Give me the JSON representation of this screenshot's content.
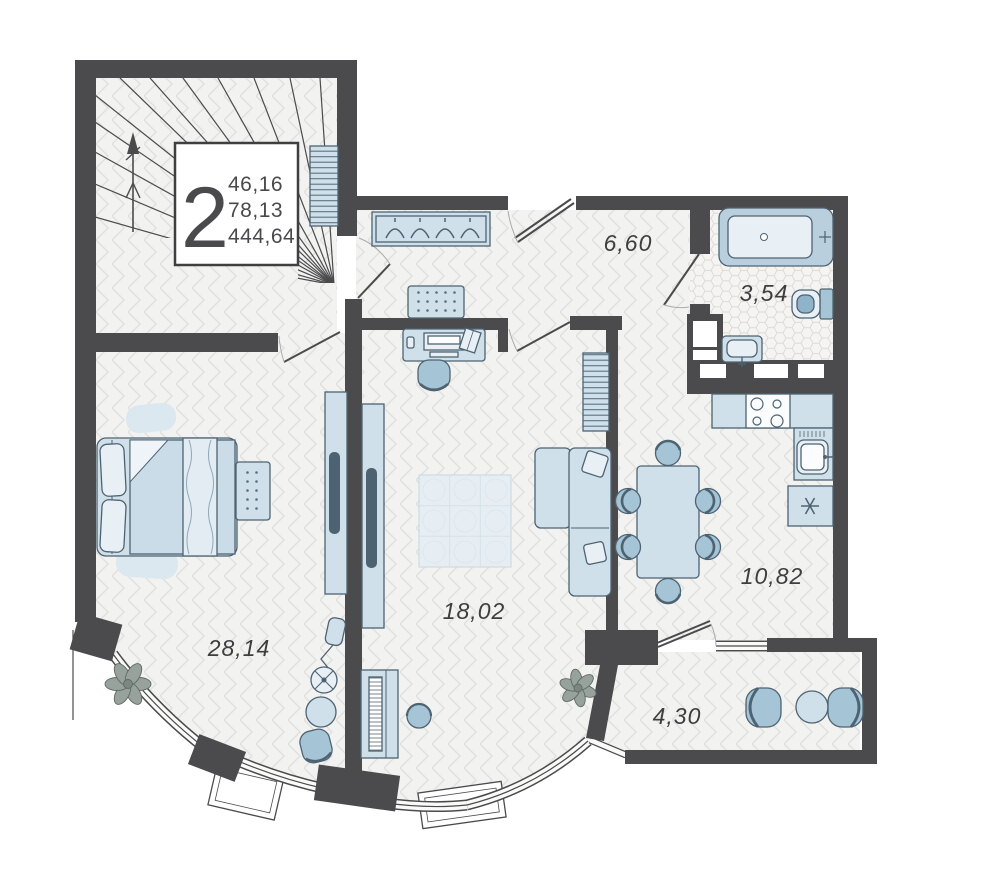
{
  "unit_card": {
    "rooms_count": "2",
    "value_1": "46,16",
    "value_2": "78,13",
    "value_3": "444,64"
  },
  "rooms": [
    {
      "name": "hallway",
      "area": "6,60"
    },
    {
      "name": "bathroom",
      "area": "3,54"
    },
    {
      "name": "kitchen-dining",
      "area": "10,82"
    },
    {
      "name": "living-room",
      "area": "18,02"
    },
    {
      "name": "bedroom",
      "area": "28,14"
    },
    {
      "name": "balcony",
      "area": "4,30"
    }
  ],
  "colors": {
    "wall": "#4b4b4d",
    "floor": "#f2f2f1",
    "floor_line": "#e0e0df",
    "furniture_light": "#cfe0ea",
    "furniture_medium": "#a5c4d6",
    "furniture_outline": "#4e6372",
    "label_text": "#3e3e40"
  }
}
